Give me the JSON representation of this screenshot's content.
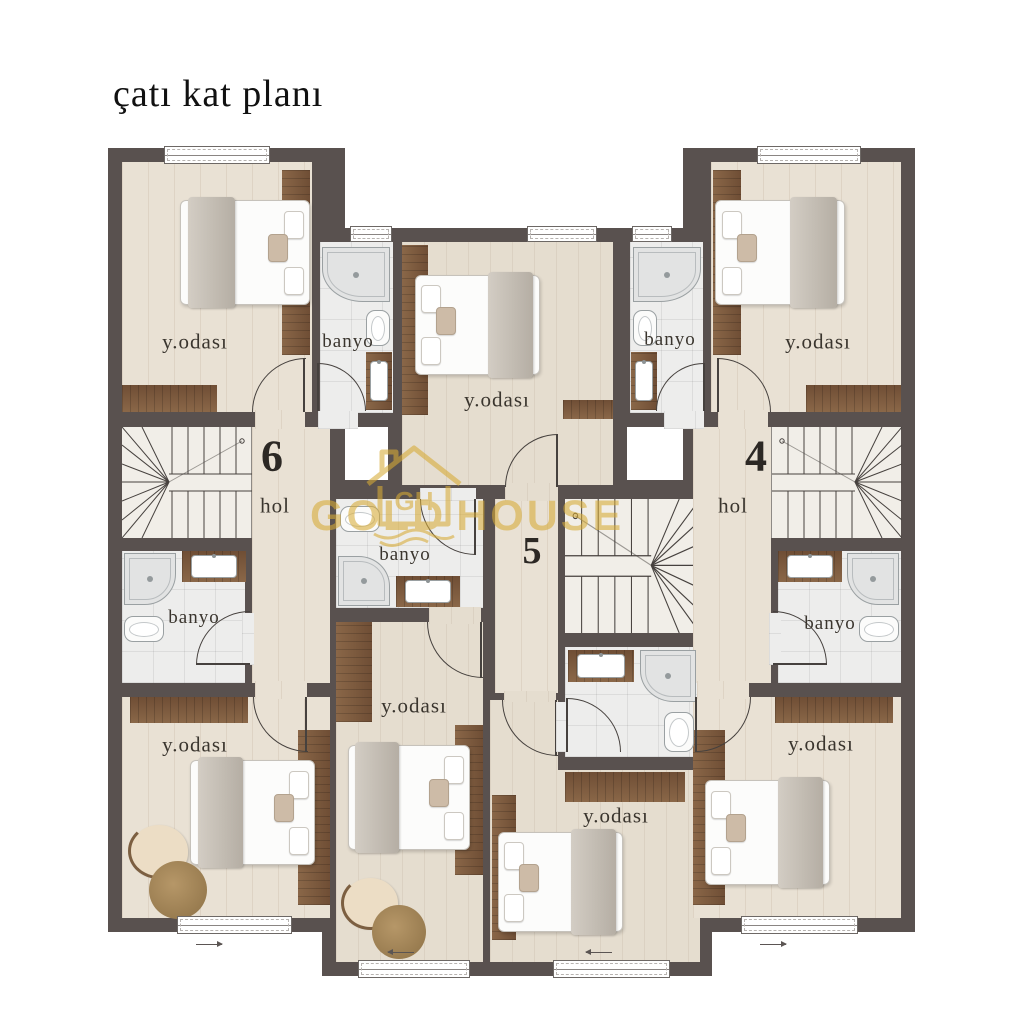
{
  "title": "çatı kat planı",
  "watermark": {
    "gold": "GOLD",
    "house": "HOUSE",
    "monogram": "GH",
    "color": "#d7ab36"
  },
  "unit_numbers": [
    {
      "id": "unit-6",
      "value": "6"
    },
    {
      "id": "unit-5",
      "value": "5"
    },
    {
      "id": "unit-4",
      "value": "4"
    }
  ],
  "rooms": [
    {
      "id": "bedroom-top-left",
      "type": "bedroom",
      "label": "y.odası"
    },
    {
      "id": "bathroom-top-left",
      "type": "bathroom",
      "label": "banyo"
    },
    {
      "id": "bedroom-top-center",
      "type": "bedroom",
      "label": "y.odası"
    },
    {
      "id": "bathroom-top-right",
      "type": "bathroom",
      "label": "banyo"
    },
    {
      "id": "bedroom-top-right",
      "type": "bedroom",
      "label": "y.odası"
    },
    {
      "id": "hall-left",
      "type": "hall",
      "label": "hol"
    },
    {
      "id": "hall-right",
      "type": "hall",
      "label": "hol"
    },
    {
      "id": "bathroom-mid-left",
      "type": "bathroom",
      "label": "banyo"
    },
    {
      "id": "bathroom-center",
      "type": "bathroom",
      "label": "banyo"
    },
    {
      "id": "bathroom-mid-right",
      "type": "bathroom",
      "label": "banyo"
    },
    {
      "id": "bedroom-bottom-left",
      "type": "bedroom",
      "label": "y.odası"
    },
    {
      "id": "bedroom-bottom-center-left",
      "type": "bedroom",
      "label": "y.odası"
    },
    {
      "id": "bedroom-bottom-center-right",
      "type": "bedroom",
      "label": "y.odası"
    },
    {
      "id": "bedroom-bottom-right",
      "type": "bedroom",
      "label": "y.odası"
    }
  ],
  "colors": {
    "wall": "#59514f",
    "floor_wood": "#e9e1d4",
    "floor_tile": "#ededec",
    "floor_stairs": "#f1eee8",
    "accent_wood": "#7d5a3f",
    "watermark_gold": "#d7ab36"
  }
}
